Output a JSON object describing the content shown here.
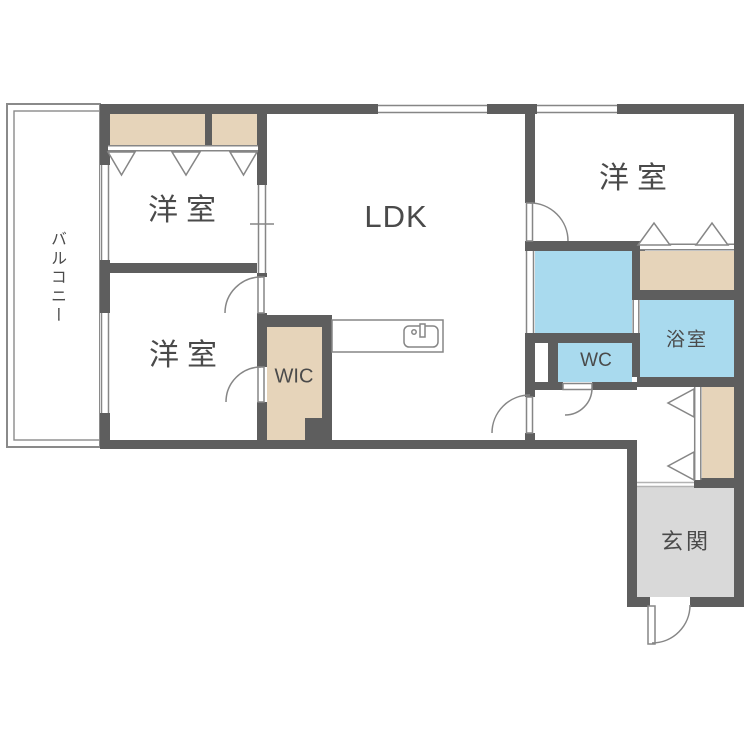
{
  "labels": {
    "room1": "洋室",
    "room2": "洋室",
    "room3": "洋室",
    "ldk": "LDK",
    "wic": "WIC",
    "wc": "WC",
    "bath": "浴室",
    "genkan": "玄関",
    "balcony": "バルコニー"
  },
  "colors": {
    "wall": "#5e5e5e",
    "closet": "#e6d4ba",
    "water": "#a9daee",
    "entrance_floor": "#d9d9d9",
    "line": "#868686",
    "label_text": "#4a4a4a",
    "background": "#ffffff"
  }
}
